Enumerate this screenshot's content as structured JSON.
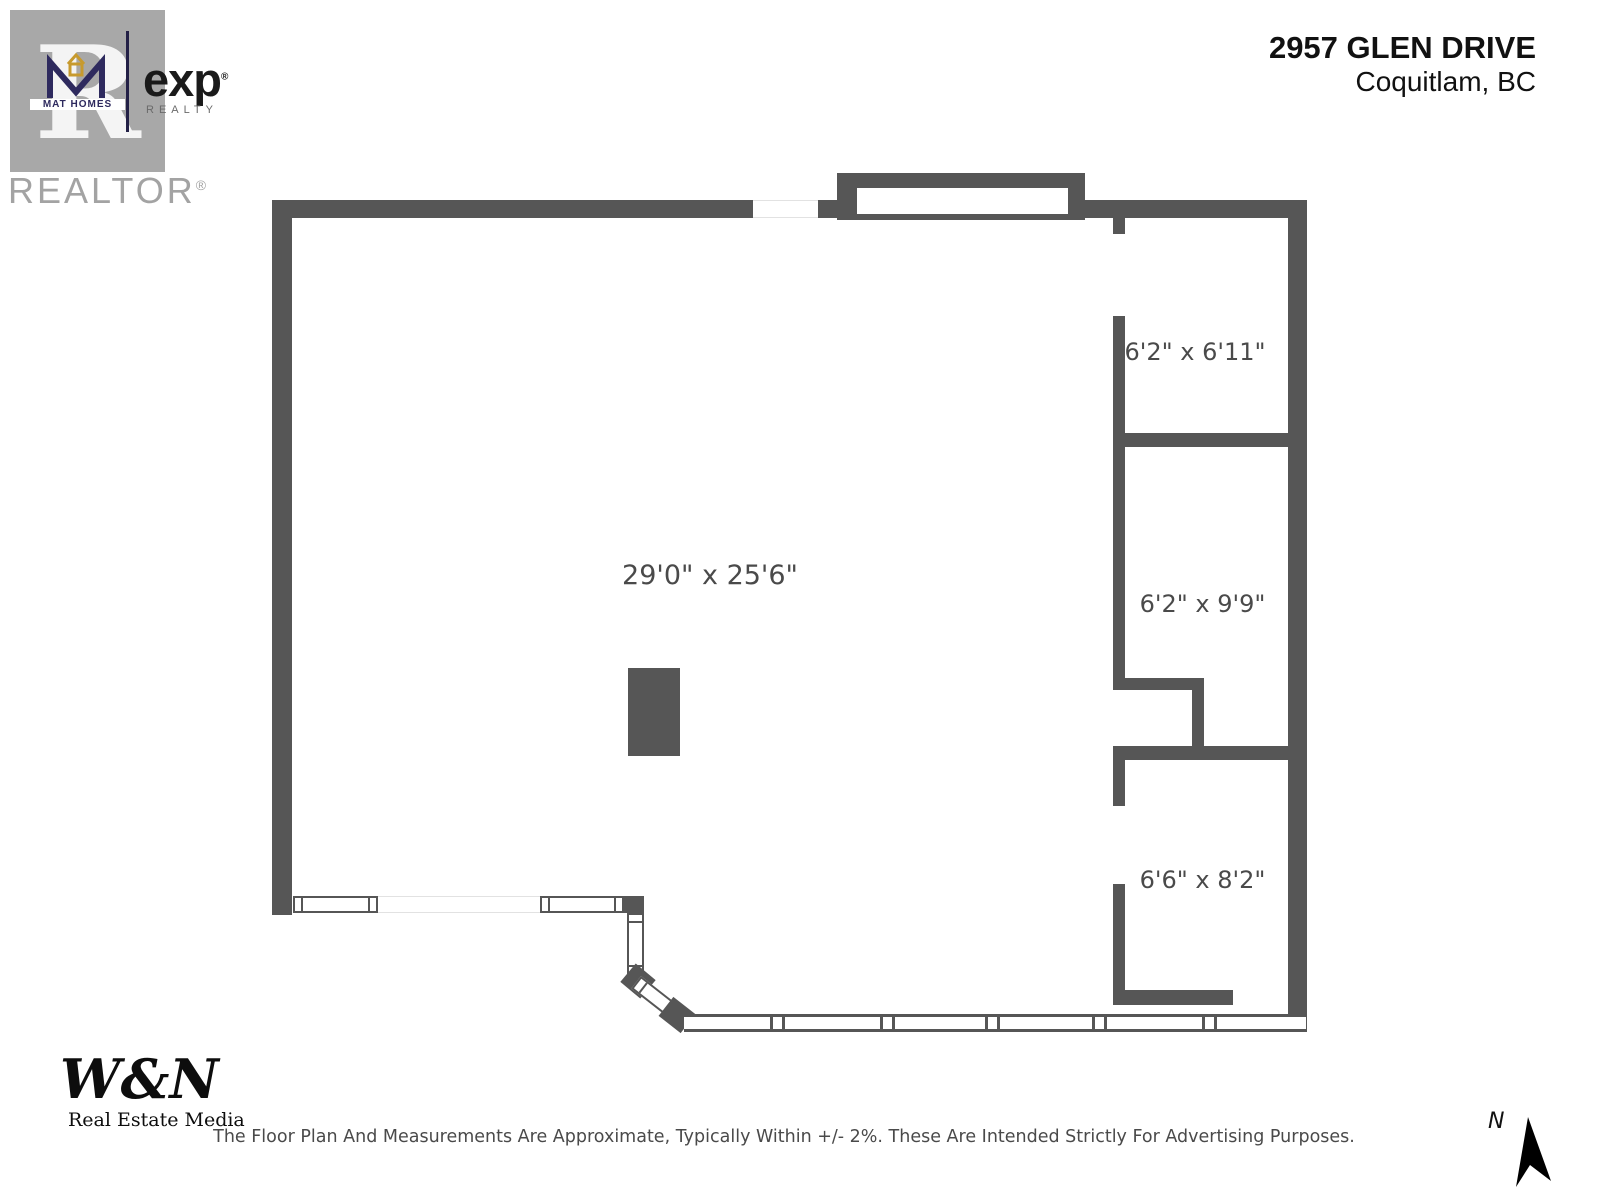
{
  "header": {
    "address_line1": "2957 GLEN DRIVE",
    "address_line2": "Coquitlam, BC"
  },
  "branding": {
    "realtor_r": "R",
    "realtor_word": "REALTOR",
    "realtor_registered": "®",
    "mat_homes_label": "MAT HOMES",
    "exp_label": "exp",
    "exp_registered": "®",
    "exp_sub_label": "REALTY",
    "wn_label": "W&N",
    "wn_sub_label": "Real Estate Media"
  },
  "floor_plan": {
    "main_room": {
      "label": "29'0\" x 25'6\""
    },
    "rooms": [
      {
        "label": "6'2\" x 6'11\""
      },
      {
        "label": "6'2\" x 9'9\""
      },
      {
        "label": "6'6\" x 8'2\""
      }
    ]
  },
  "compass": {
    "label": "N"
  },
  "footer": {
    "disclaimer": "The Floor Plan And Measurements Are Approximate, Typically Within +/- 2%. These Are Intended Strictly For Advertising Purposes."
  },
  "colors": {
    "wall": "#565656",
    "dimension_text": "#4a4a4a",
    "brand_navy": "#2e2a5e",
    "brand_gold": "#c79a2e"
  }
}
